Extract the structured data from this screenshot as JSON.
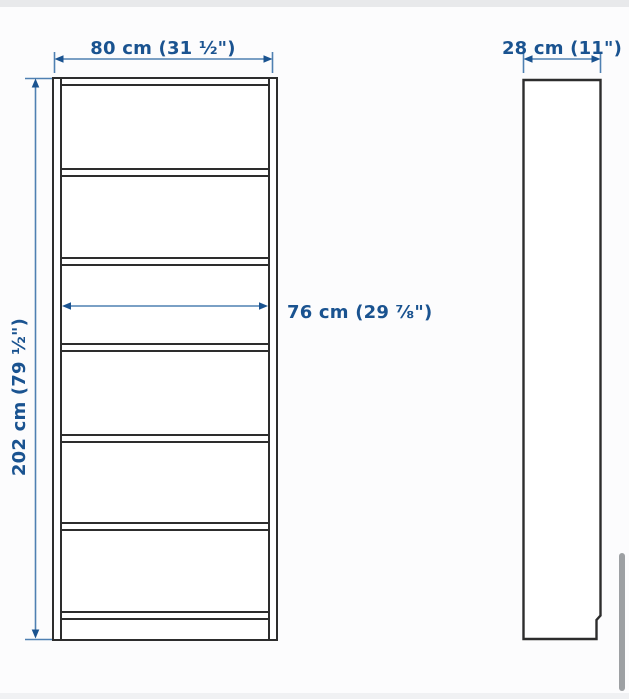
{
  "diagram": {
    "title": "bookcase-dimension-diagram",
    "labels": {
      "front_width": "80 cm (31 ½\")",
      "front_height": "202 cm (79 ½\")",
      "front_inner_width": "76 cm (29 ⅞\")",
      "side_depth": "28 cm (11\")"
    },
    "front_view": {
      "compartments": 6,
      "shelves": 5
    },
    "side_view": {
      "plinth_notch": "bottom-right"
    }
  },
  "colors": {
    "dimension_text": "#1a5390",
    "dimension_line": "#4f80b2",
    "outline": "#2d2d2d",
    "fill": "#ffffff",
    "top_strip": "#e8e9eb",
    "bottom_strip": "#f0f1f3",
    "scrollbar": "#9da0a3",
    "background": "#fcfcfd"
  }
}
